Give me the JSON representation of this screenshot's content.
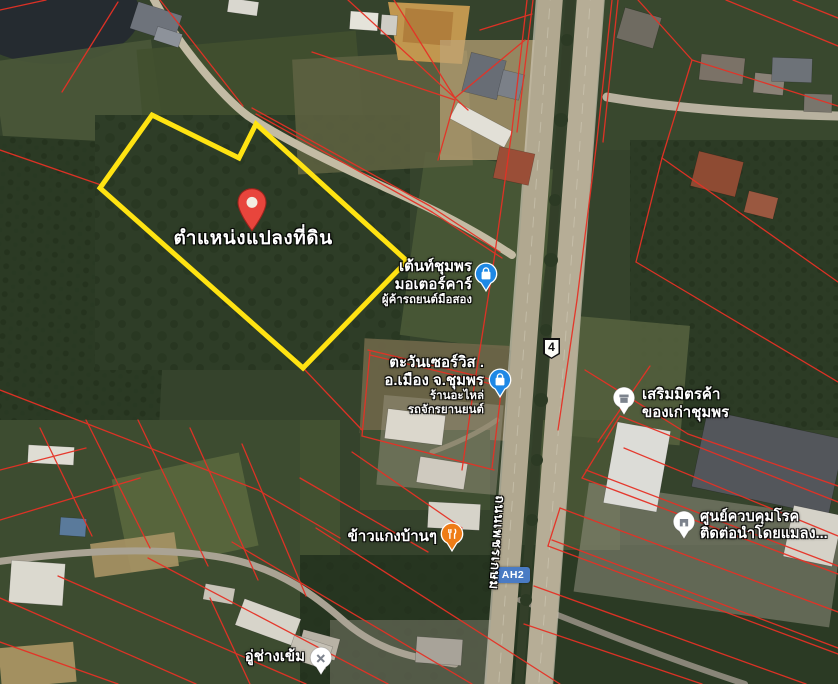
{
  "colors": {
    "plot-yellow": "#ffe312",
    "cadastral-red": "#e63125",
    "pin-red": "#e8453c",
    "poi-blue": "#1e88e5",
    "poi-orange": "#ee7c17",
    "poi-gray-glyph": "#7d838d",
    "shield-blue": "#4a7bc4",
    "label-white": "#ffffff"
  },
  "map": {
    "view_type": "satellite",
    "pin": {
      "label": "ตำแหน่งแปลงที่ดิน"
    },
    "road": {
      "name": "ถนนเพชรเกษม",
      "shields": [
        {
          "text": "4"
        },
        {
          "text": "AH2"
        }
      ]
    },
    "pois": [
      {
        "category": "shopping",
        "name_lines": [
          "เต้นท์ชุมพร",
          "มอเตอร์คาร์"
        ],
        "detail_lines": [
          "ผู้ค้ารถยนต์มือสอง"
        ]
      },
      {
        "category": "shopping",
        "name_lines": [
          "ตะวันเซอร์วิส .",
          "อ.เมือง จ.ชุมพร"
        ],
        "detail_lines": [
          "ร้านอะไหล่",
          "รถจักรยานยนต์"
        ]
      },
      {
        "category": "store",
        "name_lines": [
          "เสริมมิตรค้า",
          "ของเก่าชุมพร"
        ],
        "detail_lines": []
      },
      {
        "category": "restaurant",
        "name_lines": [
          "ข้าวแกงบ้านๆ"
        ],
        "detail_lines": []
      },
      {
        "category": "government",
        "name_lines": [
          "ศูนย์ควบคุมโรค",
          "ติดต่อนำโดยแมลง..."
        ],
        "detail_lines": []
      },
      {
        "category": "car-repair",
        "name_lines": [
          "อู่ช่างเข้ม"
        ],
        "detail_lines": []
      }
    ]
  }
}
